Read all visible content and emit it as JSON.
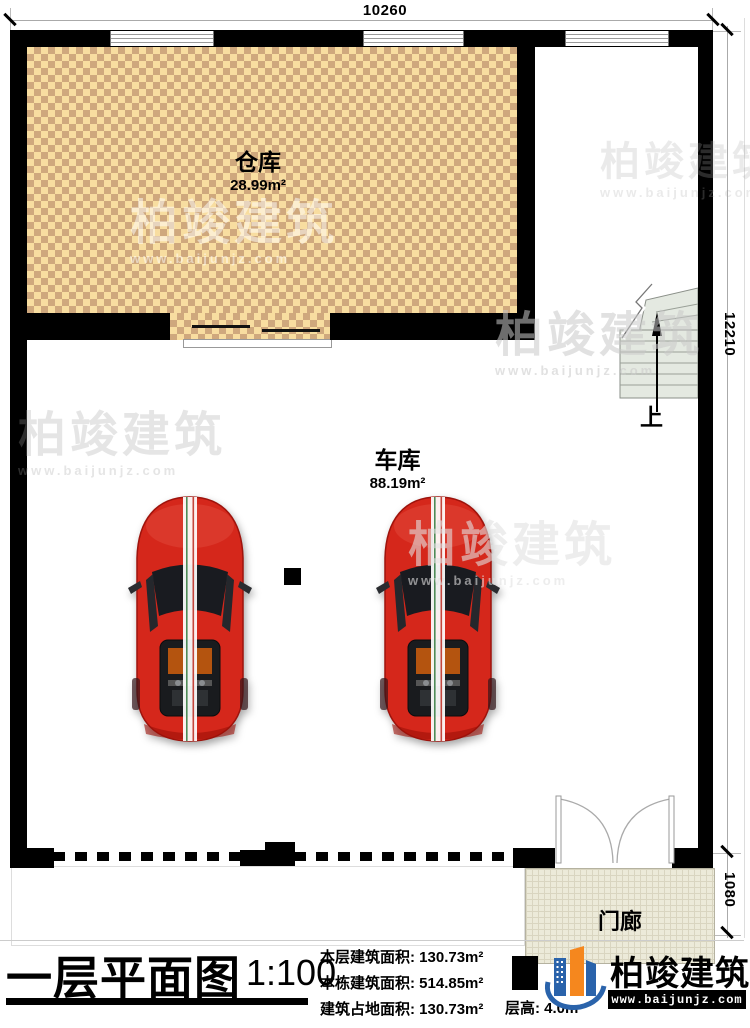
{
  "dims": {
    "top": "10260",
    "right_main": "12210",
    "right_porch": "1080"
  },
  "rooms": {
    "warehouse": {
      "name": "仓库",
      "area": "28.99m²"
    },
    "garage": {
      "name": "车库",
      "area": "88.19m²"
    },
    "porch": {
      "name": "门廊"
    },
    "up": "上"
  },
  "title_block": {
    "title": "一层平面图",
    "scale": "1:100",
    "stats": [
      "本层建筑面积: 130.73m²",
      "本栋建筑面积: 514.85m²",
      "建筑占地面积: 130.73m²"
    ],
    "floor_height": "层高: 4.0m"
  },
  "brand": {
    "name": "柏竣建筑",
    "website": "www.baijunjz.com"
  },
  "watermark": {
    "text": "柏竣建筑",
    "url": "www.baijunjz.com"
  },
  "colors": {
    "wall": "#000000",
    "warehouse_floor_light": "#f8dda0",
    "warehouse_floor_dark": "#cfa87d",
    "porch_floor": "#ecead9",
    "stairs": "#e4e9e1",
    "car_red": "#d5271b",
    "brand_blue": "#2a63ab",
    "brand_orange": "#f5871e"
  }
}
